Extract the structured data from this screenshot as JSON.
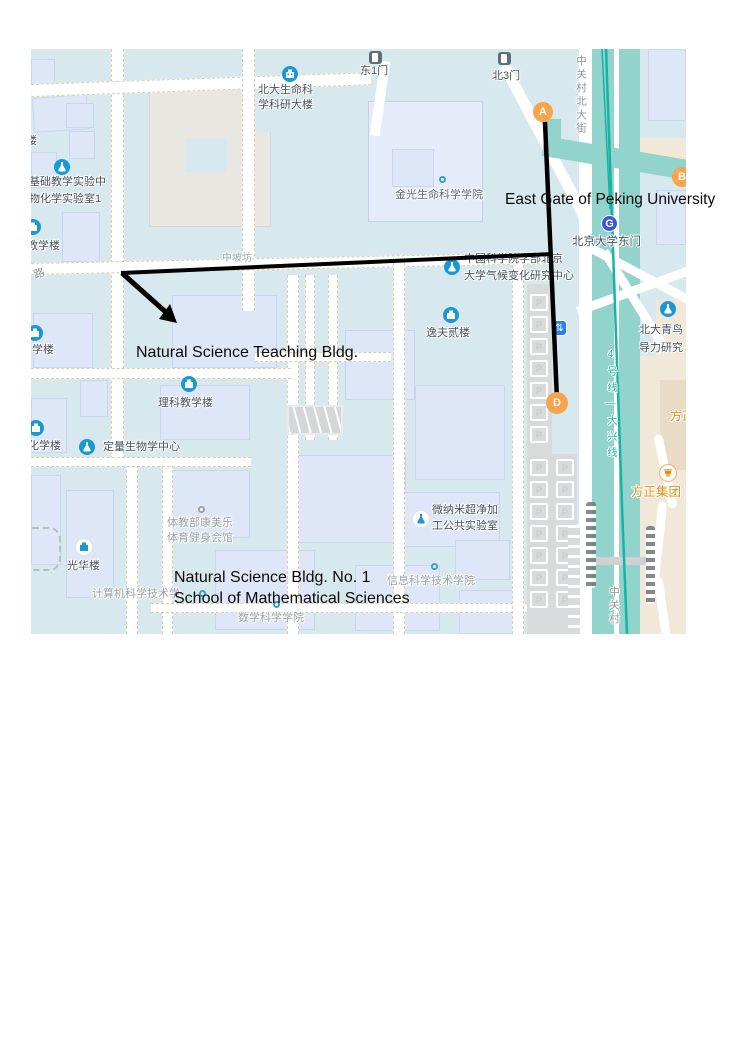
{
  "annotations": {
    "east_gate": "East Gate of Peking University",
    "teaching_bldg": "Natural Science Teaching Bldg.",
    "bldg_no1": "Natural Science Bldg. No. 1",
    "math_school": "School of Mathematical Sciences"
  },
  "markers": {
    "a": "A",
    "b": "B",
    "d": "D"
  },
  "metro": {
    "station": "北京大学东门",
    "logo": "G",
    "line_label": "4号线—大兴线",
    "entrance_glyph": "⇅"
  },
  "streets": {
    "zgc_north_vertical": "中关村北大街",
    "zgc_south_vertical": "中关村",
    "road_partial": "路",
    "covered_label": "中坡坊"
  },
  "gates": {
    "east1": "东1门",
    "north3": "北3门"
  },
  "pois": {
    "life_sci": {
      "line1": "北大生命科",
      "line2": "学科研大楼"
    },
    "basic_lab": {
      "line1": "基础教学实验中",
      "line2": "物化学实验室1"
    },
    "jiaoxuelou": "教学楼",
    "lou_partial": "楼",
    "xuelou": "学楼",
    "huaxuelou": "化学楼",
    "quant_bio": "定量生物学中心",
    "jinguang": "金光生命科学学院",
    "cas": {
      "line1": "中国科学院学部北京",
      "line2": "大学气候变化研究中心"
    },
    "yifu": "逸夫贰楼",
    "like_teaching": "理科教学楼",
    "gym": {
      "line1": "体教部康美乐",
      "line2": "体育健身会馆"
    },
    "guanghua": "光华楼",
    "cs": "计算机科学技术学",
    "math": "数学科学学院",
    "info": "信息科学技术学院",
    "micro_nano": {
      "line1": "微纳米超净加",
      "line2": "工公共实验室"
    },
    "qingniao": {
      "line1": "北大青鸟",
      "line2": "导力研究"
    },
    "founder_partial": "方正",
    "founder_group": "方正集团"
  },
  "parking_letter": "P",
  "colors": {
    "map_bg": "#d8e8ef",
    "building": "#dde7f7",
    "teal_road": "#92d3cb",
    "subway_line": "#17b3a6",
    "beige_area": "#f1e8d9",
    "poi_blue": "#1898d5",
    "marker_orange": "#f7a44c",
    "metro_blue": "#3b55d4",
    "annotation_black": "#0b0b0b",
    "founder_orange": "#e09213"
  }
}
